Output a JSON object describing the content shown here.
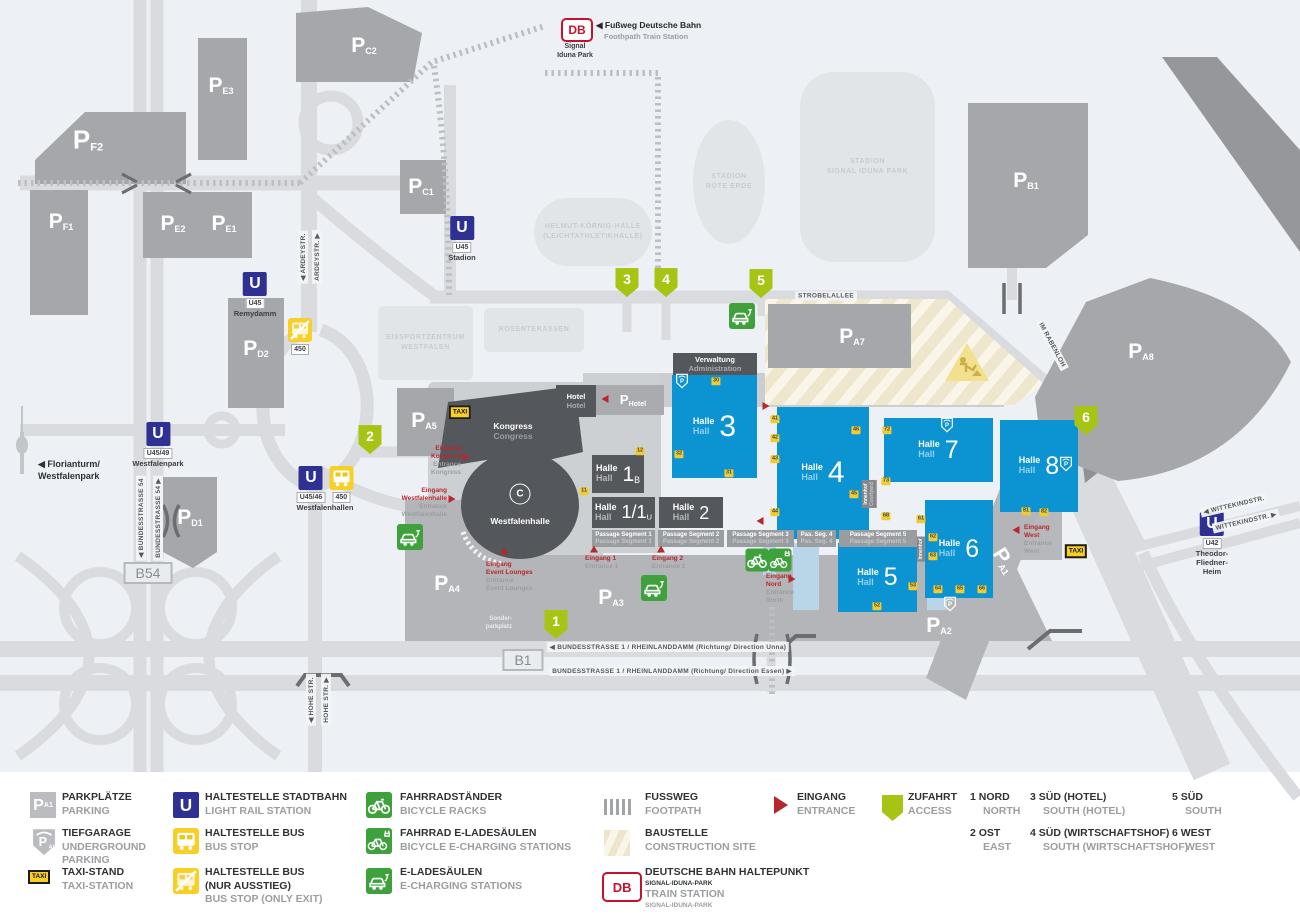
{
  "glyphs": {
    "p": "P",
    "u": "U",
    "db": "DB",
    "taxi": "TAXI",
    "p_sub_sample": "A1"
  },
  "header": {
    "station_line1": "Signal",
    "station_line2": "Iduna Park",
    "footpath_de": "◀ Fußweg Deutsche Bahn",
    "footpath_en": "Foothpath Train Station"
  },
  "map": {
    "hall_de": "Halle",
    "hall_en": "Hall",
    "parking_labels": [
      {
        "id": "F2",
        "x": 88,
        "y": 140,
        "size": "lg"
      },
      {
        "id": "F1",
        "x": 61,
        "y": 222
      },
      {
        "id": "E3",
        "x": 221,
        "y": 86
      },
      {
        "id": "E2",
        "x": 173,
        "y": 224
      },
      {
        "id": "E1",
        "x": 224,
        "y": 224
      },
      {
        "id": "C2",
        "x": 364,
        "y": 46
      },
      {
        "id": "C1",
        "x": 421,
        "y": 187
      },
      {
        "id": "D2",
        "x": 256,
        "y": 349
      },
      {
        "id": "D1",
        "x": 190,
        "y": 518
      },
      {
        "id": "A5",
        "x": 424,
        "y": 421
      },
      {
        "id": "A4",
        "x": 447,
        "y": 584
      },
      {
        "id": "A3",
        "x": 611,
        "y": 598
      },
      {
        "id": "A2",
        "x": 939,
        "y": 626
      },
      {
        "id": "A1",
        "x": 1004,
        "y": 561,
        "rot": 58
      },
      {
        "id": "A7",
        "x": 852,
        "y": 337
      },
      {
        "id": "A8",
        "x": 1141,
        "y": 352
      },
      {
        "id": "B1",
        "x": 1026,
        "y": 181
      },
      {
        "id": "Hotel",
        "x": 633,
        "y": 400,
        "size": "sm"
      }
    ],
    "halls": [
      {
        "id": "hall-3",
        "x": 672,
        "y": 375,
        "w": 85,
        "h": 103,
        "num": "3",
        "style": "blue",
        "ns": 30
      },
      {
        "id": "hall-4",
        "x": 777,
        "y": 407,
        "w": 92,
        "h": 132,
        "num": "4",
        "style": "blue",
        "ns": 30
      },
      {
        "id": "hall-7",
        "x": 884,
        "y": 418,
        "w": 109,
        "h": 64,
        "num": "7",
        "style": "blue",
        "ns": 25
      },
      {
        "id": "hall-8",
        "x": 1000,
        "y": 420,
        "w": 78,
        "h": 92,
        "num": "8",
        "style": "blue",
        "ns": 25
      },
      {
        "id": "hall-6",
        "x": 925,
        "y": 500,
        "w": 68,
        "h": 98,
        "num": "6",
        "style": "blue",
        "ns": 25
      },
      {
        "id": "hall-5",
        "x": 838,
        "y": 543,
        "w": 79,
        "h": 69,
        "num": "5",
        "style": "blue",
        "ns": 25
      },
      {
        "id": "hall-1b",
        "x": 592,
        "y": 455,
        "w": 52,
        "h": 38,
        "num": "1",
        "sub": "B",
        "style": "dark",
        "ns": 21
      },
      {
        "id": "hall-1-1u",
        "x": 592,
        "y": 497,
        "w": 63,
        "h": 31,
        "num": "1/1",
        "sub": "U",
        "style": "dark",
        "ns": 18
      },
      {
        "id": "hall-2",
        "x": 659,
        "y": 497,
        "w": 64,
        "h": 31,
        "num": "2",
        "style": "dark",
        "ns": 18
      }
    ],
    "blocks": [
      {
        "id": "verwaltung",
        "x": 673,
        "y": 353,
        "w": 84,
        "h": 22,
        "de": "Verwaltung",
        "en": "Administration"
      },
      {
        "id": "hotel",
        "x": 556,
        "y": 385,
        "w": 40,
        "h": 32,
        "de": "Hotel",
        "en": "Hotel"
      }
    ],
    "passages": [
      {
        "x": 592,
        "y": 530,
        "w": 63,
        "h": 17,
        "de": "Passage Segment 1",
        "en": "Passage Segment 1"
      },
      {
        "x": 658,
        "y": 530,
        "w": 66,
        "h": 17,
        "de": "Passage Segment 2",
        "en": "Passage Segment 2"
      },
      {
        "x": 727,
        "y": 530,
        "w": 67,
        "h": 17,
        "de": "Passage Segment 3",
        "en": "Passage Segment 3"
      },
      {
        "x": 797,
        "y": 530,
        "w": 39,
        "h": 17,
        "de": "Pas. Seg. 4",
        "en": "Pas. Seg. 4"
      },
      {
        "x": 839,
        "y": 530,
        "w": 78,
        "h": 17,
        "de": "Passage Segment 5",
        "en": "Passage Segment 5"
      }
    ],
    "buildings": [
      {
        "x": 378,
        "y": 306,
        "w": 95,
        "h": 74,
        "r": 5,
        "lines": [
          "EISSPORTZENTRUM",
          "WESTFALEN"
        ]
      },
      {
        "x": 484,
        "y": 308,
        "w": 100,
        "h": 44,
        "r": 5,
        "lines": [
          "ROSENTERASSEN"
        ]
      },
      {
        "x": 534,
        "y": 198,
        "w": 118,
        "h": 68,
        "r": 34,
        "lines": [
          "HELMUT-KÖRNIG-HALLE",
          "(LEICHTATHLETIKHALLE)"
        ]
      },
      {
        "x": 693,
        "y": 120,
        "w": 72,
        "h": 124,
        "r": "50%",
        "lines": [
          "STADION",
          "ROTE ERDE"
        ]
      },
      {
        "x": 800,
        "y": 72,
        "w": 135,
        "h": 190,
        "r": 34,
        "lines": [
          "STADION",
          "SIGNAL IDUNA PARK"
        ]
      }
    ],
    "doors": [
      {
        "t": "30",
        "x": 716,
        "y": 381
      },
      {
        "t": "31",
        "x": 729,
        "y": 473
      },
      {
        "t": "32",
        "x": 679,
        "y": 454
      },
      {
        "t": "12",
        "x": 640,
        "y": 451
      },
      {
        "t": "11",
        "x": 584,
        "y": 491
      },
      {
        "t": "41",
        "x": 775,
        "y": 419
      },
      {
        "t": "42",
        "x": 775,
        "y": 438
      },
      {
        "t": "43",
        "x": 775,
        "y": 459
      },
      {
        "t": "44",
        "x": 775,
        "y": 512
      },
      {
        "t": "46",
        "x": 856,
        "y": 430
      },
      {
        "t": "45",
        "x": 854,
        "y": 494
      },
      {
        "t": "72",
        "x": 887,
        "y": 430
      },
      {
        "t": "73",
        "x": 886,
        "y": 481
      },
      {
        "t": "68",
        "x": 886,
        "y": 516
      },
      {
        "t": "61",
        "x": 921,
        "y": 519
      },
      {
        "t": "62",
        "x": 933,
        "y": 537
      },
      {
        "t": "63",
        "x": 933,
        "y": 556
      },
      {
        "t": "64",
        "x": 938,
        "y": 589
      },
      {
        "t": "65",
        "x": 960,
        "y": 589
      },
      {
        "t": "66",
        "x": 982,
        "y": 589
      },
      {
        "t": "53",
        "x": 913,
        "y": 586
      },
      {
        "t": "52",
        "x": 877,
        "y": 606
      },
      {
        "t": "81",
        "x": 1026,
        "y": 511
      },
      {
        "t": "82",
        "x": 1044,
        "y": 512
      }
    ],
    "access_points": [
      {
        "n": "1",
        "x": 556,
        "y": 626
      },
      {
        "n": "2",
        "x": 370,
        "y": 441
      },
      {
        "n": "3",
        "x": 627,
        "y": 284
      },
      {
        "n": "4",
        "x": 666,
        "y": 284
      },
      {
        "n": "5",
        "x": 761,
        "y": 285
      },
      {
        "n": "6",
        "x": 1086,
        "y": 422
      }
    ],
    "entrances": [
      {
        "ax": 466,
        "ay": 457,
        "dir": "right",
        "tx": 461,
        "ty": 461,
        "anchor": "right",
        "de": [
          "Eingang",
          "Kongress"
        ],
        "en": [
          "Entrance",
          "Kongress"
        ]
      },
      {
        "ax": 452,
        "ay": 499,
        "dir": "right",
        "tx": 447,
        "ty": 503,
        "anchor": "right",
        "de": [
          "Eingang",
          "Westfalenhalle"
        ],
        "en": [
          "Entrance",
          "Westfalenhalle"
        ]
      },
      {
        "ax": 504,
        "ay": 551,
        "dir": "up",
        "tx": 486,
        "ty": 577,
        "anchor": "left",
        "de": [
          "Eingang",
          "Event Lounges"
        ],
        "en": [
          "Entrance",
          "Event Lounges"
        ]
      },
      {
        "ax": 594,
        "ay": 549,
        "dir": "up",
        "tx": 585,
        "ty": 563,
        "anchor": "left",
        "de": [
          "Eingang 1"
        ],
        "en": [
          "Entrance 1"
        ]
      },
      {
        "ax": 661,
        "ay": 549,
        "dir": "up",
        "tx": 652,
        "ty": 563,
        "anchor": "left",
        "de": [
          "Eingang 2"
        ],
        "en": [
          "Entrance 2"
        ]
      },
      {
        "ax": 792,
        "ay": 579,
        "dir": "right",
        "tx": 766,
        "ty": 589,
        "anchor": "left",
        "de": [
          "Eingang",
          "Nord"
        ],
        "en": [
          "Entrance",
          "North"
        ]
      },
      {
        "ax": 1016,
        "ay": 530,
        "dir": "left",
        "tx": 1024,
        "ty": 540,
        "anchor": "left",
        "de": [
          "Eingang",
          "West"
        ],
        "en": [
          "Entrance",
          "West"
        ]
      },
      {
        "ax": 766,
        "ay": 406,
        "dir": "right"
      },
      {
        "ax": 760,
        "ay": 521,
        "dir": "left"
      },
      {
        "ax": 605,
        "ay": 399,
        "dir": "left"
      }
    ],
    "transit_stops": [
      {
        "type": "u",
        "x": 462,
        "y": 228,
        "tags": [
          "U45"
        ],
        "name": [
          "Stadion"
        ]
      },
      {
        "type": "u",
        "x": 255,
        "y": 284,
        "tags": [
          "U45"
        ],
        "name": [
          "Remydamm"
        ]
      },
      {
        "type": "u",
        "x": 158,
        "y": 434,
        "tags": [
          "U45/49"
        ],
        "name": [
          "Westfalenpark"
        ]
      },
      {
        "type": "u-bus",
        "x": 325,
        "y": 478,
        "tags": [
          "U45/46",
          "450"
        ],
        "name": [
          "Westfalenhallen"
        ]
      },
      {
        "type": "bus-exit",
        "x": 300,
        "y": 330,
        "tags": [
          "450"
        ],
        "name": []
      },
      {
        "type": "u",
        "x": 1212,
        "y": 524,
        "tags": [
          "U42"
        ],
        "name": [
          "Theodor-",
          "Fliedner-",
          "Heim"
        ]
      }
    ],
    "street_labels": [
      {
        "t": "◀ ARDEYSTR.",
        "x": 303,
        "y": 257,
        "rot": -90
      },
      {
        "t": "ARDEYSTR. ▶",
        "x": 317,
        "y": 257,
        "rot": -90
      },
      {
        "t": "◀ BUNDESSTRASSE 54",
        "x": 141,
        "y": 518,
        "rot": -90
      },
      {
        "t": "BUNDESSTRASSE 54 ▶",
        "x": 158,
        "y": 518,
        "rot": -90
      },
      {
        "t": "◀ HOHE STR.",
        "x": 311,
        "y": 700,
        "rot": -90
      },
      {
        "t": "HOHE STR. ▶",
        "x": 326,
        "y": 700,
        "rot": -90
      },
      {
        "t": "STROBELALLEE",
        "x": 826,
        "y": 296,
        "rot": 0
      },
      {
        "t": "IM RABENLOH",
        "x": 1052,
        "y": 345,
        "rot": 62
      },
      {
        "t": "◀ WITTEKINDSTR.",
        "x": 1234,
        "y": 505,
        "rot": -13
      },
      {
        "t": "WITTEKINDSTR. ▶",
        "x": 1246,
        "y": 521,
        "rot": -13
      },
      {
        "t": "◀ BUNDESSTRASSE 1 / RHEINLANDDAMM (Richtung/ Direction Unna)",
        "x": 668,
        "y": 647,
        "rot": 0
      },
      {
        "t": "BUNDESSTRASSE 1 / RHEINLANDDAMM (Richtung/ Direction Essen) ▶",
        "x": 672,
        "y": 671,
        "rot": 0
      }
    ],
    "road_badges": [
      {
        "t": "B1",
        "x": 523,
        "y": 660
      },
      {
        "t": "B54",
        "x": 148,
        "y": 573
      }
    ],
    "misc_labels": [
      {
        "cls": "sonder",
        "x": 512,
        "y": 624,
        "lines": [
          "Sonder-",
          "parkplatz"
        ]
      },
      {
        "cls": "itag",
        "x": 869,
        "y": 494,
        "rot": -90,
        "lines": [
          "Innenhof",
          "Courtyard"
        ]
      },
      {
        "cls": "itag",
        "x": 921,
        "y": 549,
        "rot": -90,
        "lines": [
          "Innenhof"
        ]
      },
      {
        "cls": "flo",
        "x": 38,
        "y": 470,
        "lines": [
          "◀ Florianturm/",
          "Westfalenpark"
        ]
      },
      {
        "cls": "klabel",
        "x": 513,
        "y": 431,
        "lines": [
          "Kongress",
          "Congress"
        ]
      },
      {
        "cls": "wlabel",
        "x": 520,
        "y": 521,
        "lines": [
          "Westfalenhalle"
        ]
      },
      {
        "cls": "wlogo",
        "x": 520,
        "y": 494,
        "lines": [
          "C"
        ]
      }
    ],
    "map_icons": [
      {
        "t": "taxi",
        "x": 460,
        "y": 412
      },
      {
        "t": "taxi",
        "x": 1076,
        "y": 551
      },
      {
        "t": "car",
        "x": 742,
        "y": 316
      },
      {
        "t": "car",
        "x": 654,
        "y": 588
      },
      {
        "t": "car",
        "x": 410,
        "y": 537
      },
      {
        "t": "bike",
        "x": 757,
        "y": 560
      },
      {
        "t": "bikec",
        "x": 780,
        "y": 560
      },
      {
        "t": "shield",
        "x": 682,
        "y": 381
      },
      {
        "t": "shield",
        "x": 947,
        "y": 425
      },
      {
        "t": "shield",
        "x": 1066,
        "y": 464
      },
      {
        "t": "shield",
        "x": 950,
        "y": 604
      },
      {
        "t": "warn",
        "x": 967,
        "y": 362
      }
    ]
  },
  "legend": {
    "items": [
      {
        "icon": "park",
        "ix": 30,
        "iy": 792,
        "tx": 62,
        "ty": 791,
        "w": 120,
        "de": "PARKPLÄTZE",
        "en": "PARKING"
      },
      {
        "icon": "shieldg",
        "ix": 31,
        "iy": 827,
        "tx": 62,
        "ty": 827,
        "w": 110,
        "de": "TIEFGARAGE",
        "en": "UNDERGROUND PARKING"
      },
      {
        "icon": "taxi",
        "ix": 28,
        "iy": 870,
        "tx": 62,
        "ty": 866,
        "w": 120,
        "de": "TAXI-STAND",
        "en": "TAXI-STATION"
      },
      {
        "icon": "u",
        "ix": 173,
        "iy": 792,
        "tx": 205,
        "ty": 791,
        "w": 175,
        "de": "HALTESTELLE STADTBAHN",
        "en": "LIGHT RAIL STATION"
      },
      {
        "icon": "bus",
        "ix": 173,
        "iy": 828,
        "tx": 205,
        "ty": 827,
        "w": 175,
        "de": "HALTESTELLE BUS",
        "en": "BUS STOP"
      },
      {
        "icon": "busx",
        "ix": 173,
        "iy": 868,
        "tx": 205,
        "ty": 866,
        "w": 125,
        "de": "HALTESTELLE BUS (NUR AUSSTIEG)",
        "en": "BUS STOP (ONLY EXIT)"
      },
      {
        "icon": "bike",
        "ix": 366,
        "iy": 792,
        "tx": 400,
        "ty": 791,
        "w": 175,
        "de": "FAHRRADSTÄNDER",
        "en": "BICYCLE RACKS"
      },
      {
        "icon": "bikec",
        "ix": 366,
        "iy": 828,
        "tx": 400,
        "ty": 827,
        "w": 210,
        "de": "FAHRRAD E-LADESÄULEN",
        "en": "BICYCLE E-CHARGING STATIONS"
      },
      {
        "icon": "car",
        "ix": 366,
        "iy": 868,
        "tx": 400,
        "ty": 866,
        "w": 175,
        "de": "E-LADESÄULEN",
        "en": "E-CHARGING STATIONS"
      },
      {
        "icon": "foot",
        "ix": 604,
        "iy": 794,
        "tx": 645,
        "ty": 791,
        "w": 120,
        "de": "FUSSWEG",
        "en": "FOOTPATH"
      },
      {
        "icon": "constr",
        "ix": 604,
        "iy": 830,
        "tx": 645,
        "ty": 827,
        "w": 160,
        "de": "BAUSTELLE",
        "en": "CONSTRUCTION SITE"
      },
      {
        "icon": "db",
        "ix": 602,
        "iy": 872,
        "tx": 645,
        "ty": 866,
        "w": 220,
        "de": "DEUTSCHE BAHN HALTEPUNKT",
        "de2": "SIGNAL-IDUNA-PARK",
        "en": "TRAIN STATION",
        "en2": "SIGNAL-IDUNA-PARK"
      },
      {
        "icon": "ent",
        "ix": 774,
        "iy": 796,
        "tx": 797,
        "ty": 791,
        "w": 90,
        "de": "EINGANG",
        "en": "ENTRANCE"
      },
      {
        "icon": "acc",
        "ix": 882,
        "iy": 795,
        "tx": 908,
        "ty": 791,
        "w": 90,
        "de": "ZUFAHRT",
        "en": "ACCESS"
      }
    ],
    "numbered": [
      {
        "n": "1",
        "de": "NORD",
        "en": "NORTH",
        "x": 970,
        "y": 791
      },
      {
        "n": "2",
        "de": "OST",
        "en": "EAST",
        "x": 970,
        "y": 827
      },
      {
        "n": "3",
        "de": "SÜD (HOTEL)",
        "en": "SOUTH (HOTEL)",
        "x": 1030,
        "y": 791
      },
      {
        "n": "4",
        "de": "SÜD (WIRTSCHAFTSHOF)",
        "en": "SOUTH (WIRTSCHAFTSHOF)",
        "x": 1030,
        "y": 827
      },
      {
        "n": "5",
        "de": "SÜD",
        "en": "SOUTH",
        "x": 1172,
        "y": 791
      },
      {
        "n": "6",
        "de": "WEST",
        "en": "WEST",
        "x": 1172,
        "y": 827
      }
    ]
  }
}
